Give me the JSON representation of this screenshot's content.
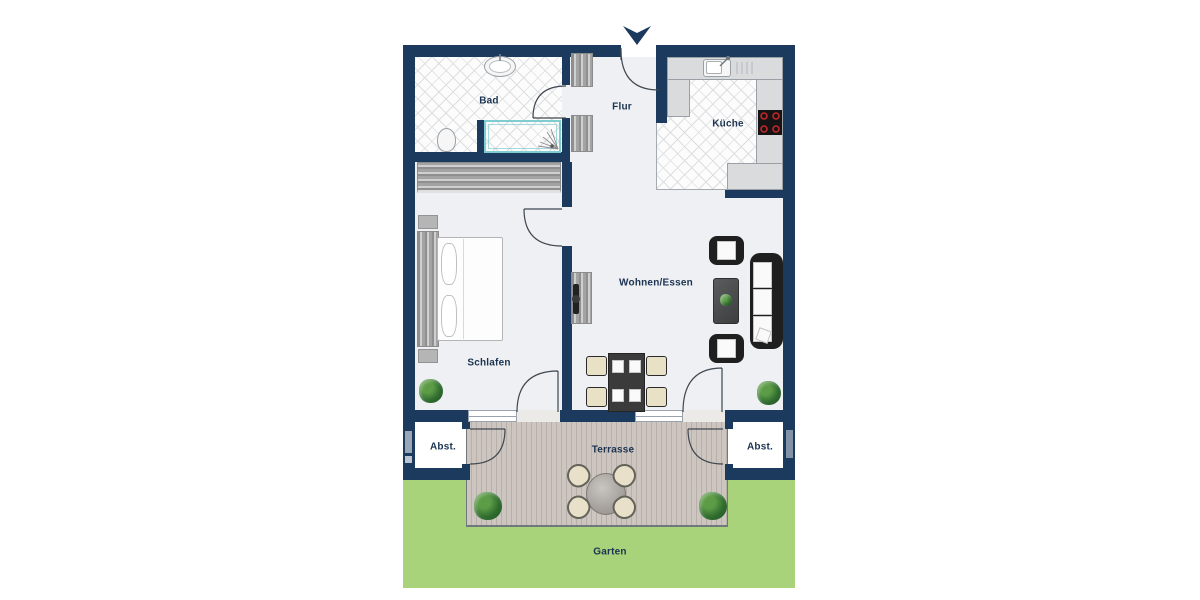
{
  "plan": {
    "title": "apartment-floorplan",
    "rooms": {
      "bad": {
        "label": "Bad"
      },
      "flur": {
        "label": "Flur"
      },
      "kueche": {
        "label": "Küche"
      },
      "schlafen": {
        "label": "Schlafen"
      },
      "wohnen": {
        "label": "Wohnen/Essen"
      },
      "abst_left": {
        "label": "Abst."
      },
      "abst_right": {
        "label": "Abst."
      },
      "terrasse": {
        "label": "Terrasse"
      },
      "garten": {
        "label": "Garten"
      }
    },
    "icons": [
      "north-entrance-arrow",
      "shower-spray",
      "stove-burners"
    ],
    "colors": {
      "wall": "#1b3a5e",
      "floor": "#eef0f4",
      "grass": "#a9d37b",
      "deck": "#cdc5bf",
      "deck_line": "#b8afa9",
      "label": "#1b3350",
      "glass": "#7fccd1",
      "stove": "#141414",
      "burner": "#c0262a"
    }
  }
}
